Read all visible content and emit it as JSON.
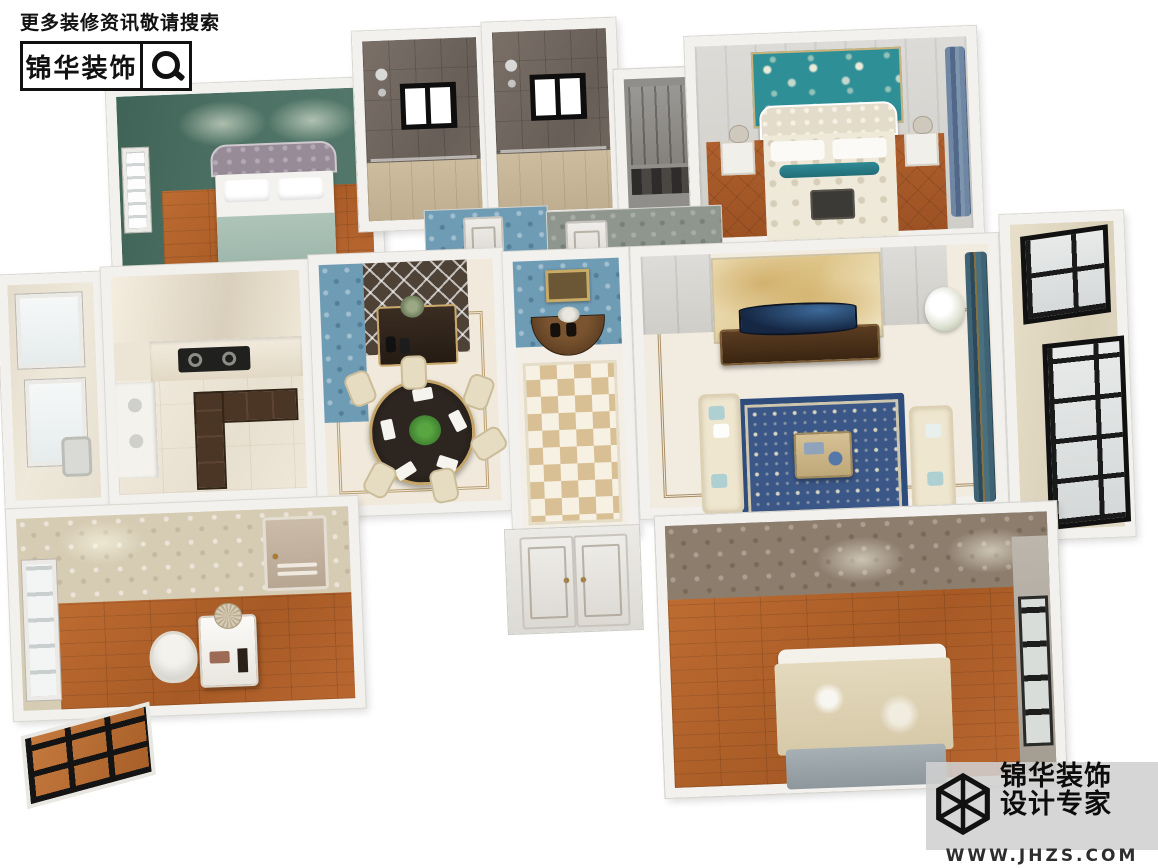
{
  "watermark_top_left": {
    "search_hint": "更多装修资讯敬请搜索",
    "brand_name": "锦华装饰",
    "icon": "magnifier-icon"
  },
  "watermark_bottom_right": {
    "brand_name": "锦华装饰",
    "tagline": "设计专家",
    "website": "WWW.JHZS.COM",
    "icon": "wireframe-cube-logo",
    "band_color": "#d0d0d0"
  },
  "scene": {
    "render_style": "isometric-3d-dollhouse-floorplan-render",
    "palette": {
      "wall_white": "#f2f1ee",
      "bedroom_green_wall": "#4d7265",
      "master_accent_teal": "#2f8f97",
      "entry_wallpaper_blue": "#6f9cb5",
      "rug_blue": "#3a5787",
      "wood_floor": "#b5662f",
      "marble_floor": "#ece4d4",
      "tv_wall_marble_gold": "#dec589"
    },
    "rooms": [
      {
        "id": "bedroom-secondary",
        "position": "top-left",
        "wall": "#4d7265",
        "floor": "wood",
        "contents": [
          "double-bed-gray-headboard",
          "white-pillows",
          "sage-blanket",
          "window-left"
        ]
      },
      {
        "id": "bathroom-left",
        "position": "top-center",
        "wall": "#746a61",
        "floor": "#cdbc9e",
        "contents": [
          "shower-head",
          "black-frame-window",
          "glass-partition"
        ]
      },
      {
        "id": "bathroom-right",
        "position": "top-center",
        "wall": "#746a61",
        "floor": "#cdbc9e",
        "contents": [
          "shower-head",
          "black-frame-window",
          "glass-partition"
        ]
      },
      {
        "id": "walk-in-closet",
        "position": "top-middle",
        "wall": "#908e8a",
        "contents": [
          "gray-wardrobe",
          "shelf"
        ]
      },
      {
        "id": "master-bedroom",
        "position": "top-right",
        "wall": "#d8d7d3",
        "accent_wall": "#2f8f97",
        "floor": "parquet",
        "contents": [
          "tufted-white-bed",
          "teal-bolster",
          "nightstand-left",
          "nightstand-right",
          "table-lamps",
          "blue-curtains"
        ]
      },
      {
        "id": "service-balcony",
        "position": "mid-left",
        "floor": "#e9e3d5",
        "contents": [
          "windows",
          "laundry-sink"
        ]
      },
      {
        "id": "kitchen",
        "position": "mid-left",
        "floor": "#ece4d4",
        "contents": [
          "gas-stove",
          "marble-counter",
          "dark-cabinets",
          "sink-counter",
          "window"
        ]
      },
      {
        "id": "dining-room",
        "position": "center",
        "wall": "#6f9cb5",
        "floor": "#f1eadc",
        "contents": [
          "round-black-table",
          "six-cream-chairs",
          "dark-sideboard",
          "mirror-lattice-wall",
          "green-plant",
          "place-settings"
        ]
      },
      {
        "id": "entry-hall",
        "position": "center",
        "wall": "#6f9cb5",
        "floor": "pinwheel-tile",
        "contents": [
          "gold-framed-painting",
          "half-moon-console",
          "vases"
        ]
      },
      {
        "id": "living-room",
        "position": "center-right",
        "floor": "#f1ebe0",
        "contents": [
          "gold-marble-tv-wall",
          "curved-tv",
          "dark-tv-cabinet",
          "blue-ornate-rug",
          "cream-sofa-left",
          "cream-sofa-right",
          "coffee-table",
          "white-flower-arrangement",
          "teal-gold-curtains"
        ]
      },
      {
        "id": "sun-balcony",
        "position": "right",
        "floor": "#ded6c2",
        "contents": [
          "black-frame-floor-windows"
        ]
      },
      {
        "id": "study",
        "position": "bottom-left",
        "wall": "#d6cbb3",
        "floor": "wood",
        "contents": [
          "white-desk",
          "desk-lamp",
          "white-chair",
          "interior-door",
          "window",
          "exterior-black-grid-window"
        ]
      },
      {
        "id": "bedroom-south",
        "position": "bottom-right",
        "wall": "#8d7d6d",
        "floor": "wood",
        "contents": [
          "bed-cream-paisley-blanket",
          "gray-throw",
          "dark-window-right"
        ]
      },
      {
        "id": "entry-double-door",
        "position": "bottom-center",
        "color": "#eceae6",
        "contents": [
          "two-door-leaves",
          "gold-handles"
        ]
      },
      {
        "id": "hallway-walls",
        "position": "center-north",
        "wallpapers": [
          "#6f9cb5",
          "#8e968e"
        ],
        "contents": [
          "door-openings"
        ]
      }
    ]
  }
}
